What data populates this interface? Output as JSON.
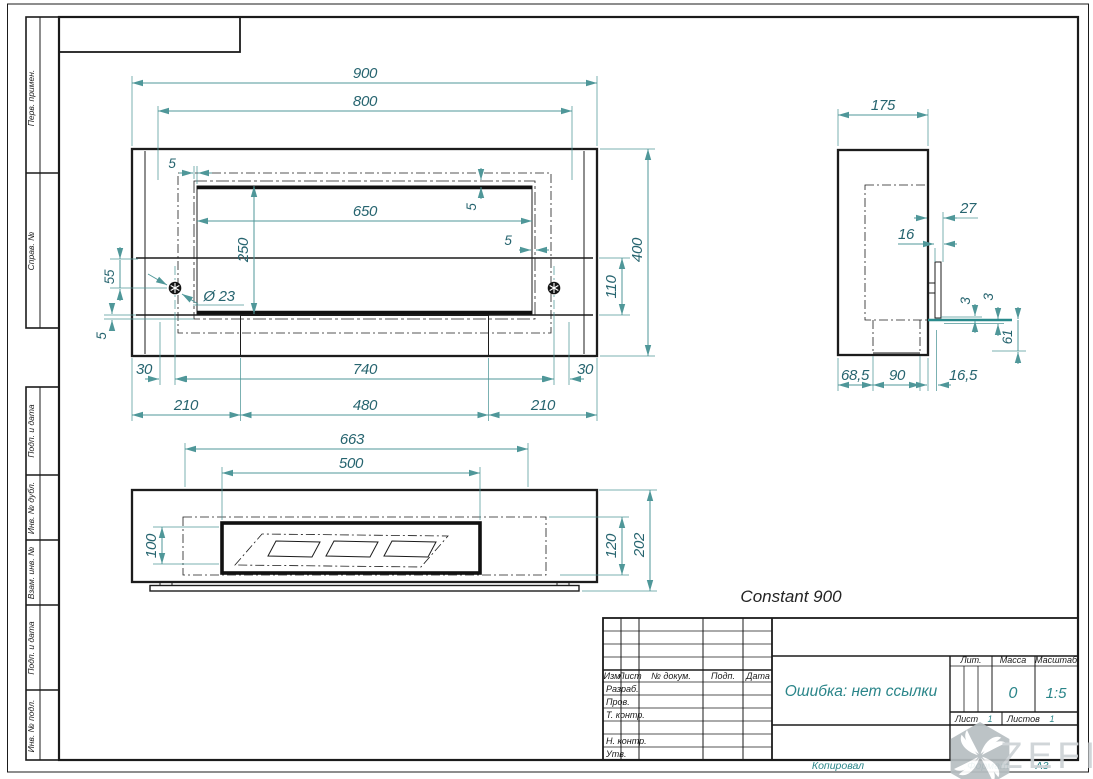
{
  "product": {
    "name": "Constant 900"
  },
  "colors": {
    "dim_line": "#4f9799",
    "dim_text": "#26646f",
    "drawing": "#1c1c1c",
    "value_text": "#2a8589",
    "watermark": "#cdd2d5"
  },
  "views": {
    "front": {
      "overall_width": "900",
      "inner_width": "800",
      "opening_width": "650",
      "opening_height": "250",
      "gap_top_left": "5",
      "gap_right_top": "5",
      "gap_right_side": "5",
      "gap_bottom_left": "5",
      "bolt_offset": "55",
      "hole_diameter": "Ø 23",
      "overall_height": "400",
      "shelf_height": "110",
      "margin_left": "30",
      "bolt_span": "740",
      "margin_right": "30",
      "left_span": "210",
      "center_span": "480",
      "right_span": "210"
    },
    "plan": {
      "block_width": "663",
      "tray_width": "500",
      "tray_depth": "100",
      "inner_depth": "120",
      "overall_depth": "202"
    },
    "side": {
      "depth": "175",
      "bracket_offset": "27",
      "bracket_width": "16",
      "glass_gap_a": "3",
      "glass_gap_b": "3",
      "foot_height": "61",
      "base_front": "68,5",
      "base_mid": "90",
      "base_back": "16,5"
    }
  },
  "frame": {
    "margin_labels": [
      "Перв. примен.",
      "Справ. №",
      "Подп. и дата",
      "Инв. № дубл.",
      "Взам. инв. №",
      "Подп. и дата",
      "Инв. № подл."
    ]
  },
  "title_block": {
    "columns": {
      "izm": "Изм",
      "list": "Лист",
      "docnum": "№ докум.",
      "podp": "Подп.",
      "data": "Дата"
    },
    "rows": {
      "razrab": "Разраб.",
      "prov": "Пров.",
      "tkontr": "Т. контр.",
      "nkontr": "Н. контр.",
      "utv": "Утв."
    },
    "doc_name": "Ошибка: нет ссылки",
    "lit_label": "Лит.",
    "mass_label": "Масса",
    "scale_label": "Масштаб",
    "mass_value": "0",
    "scale_value": "1:5",
    "sheet_label": "Лист",
    "sheet_value": "1",
    "sheets_label": "Листов",
    "sheets_value": "1"
  },
  "footer": {
    "copied": "Копировал",
    "format_label": "Формат",
    "format_value": "А3"
  },
  "watermark": {
    "brand": "ZEFIRE"
  }
}
